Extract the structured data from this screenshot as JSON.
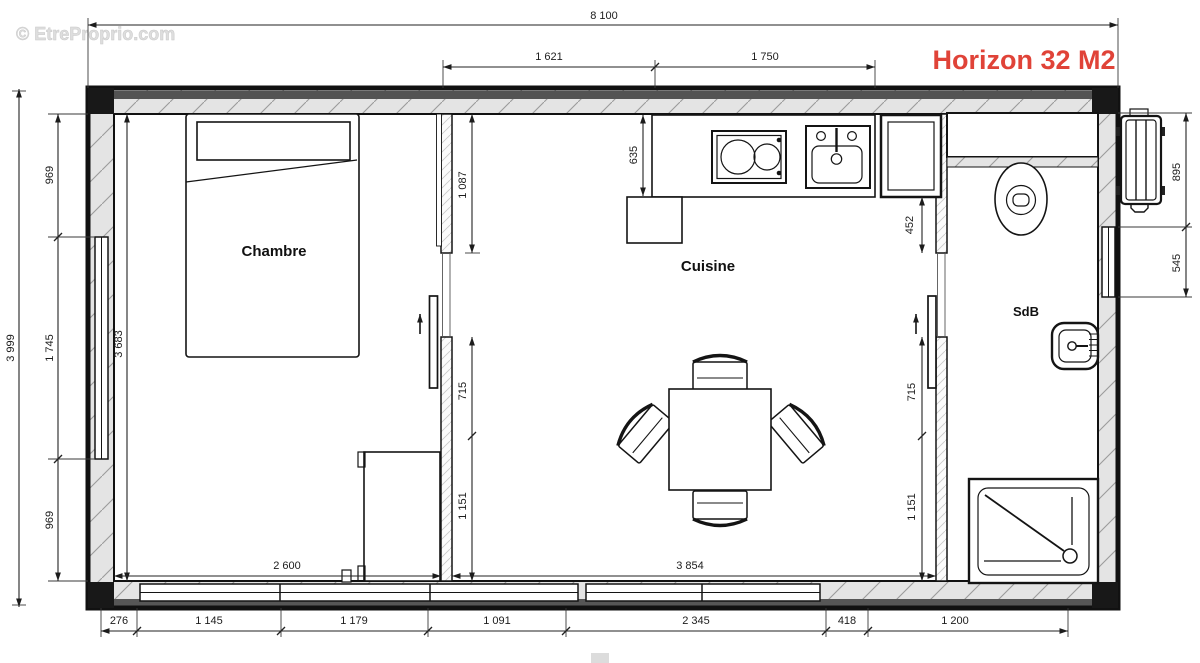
{
  "header": {
    "watermark": "© EtreProprio.com",
    "title": "Horizon 32 M2"
  },
  "rooms": {
    "bedroom": "Chambre",
    "kitchen": "Cuisine",
    "bathroom": "SdB"
  },
  "dims": {
    "overall_width": "8 100",
    "overall_height": "3 999",
    "top": [
      "1 621",
      "1 750"
    ],
    "left": [
      "969",
      "1 745",
      "969"
    ],
    "right": [
      "895",
      "545"
    ],
    "bottom": [
      "276",
      "1 145",
      "1 179",
      "1 091",
      "2 345",
      "418",
      "1 200"
    ],
    "bedroom_depth": "3 683",
    "bedroom_width": "2 600",
    "kitchen_width": "3 854",
    "counter_depth": "635",
    "partition_bedroom": [
      "1 087",
      "715",
      "1 151"
    ],
    "partition_bathroom": [
      "452",
      "715",
      "1 151"
    ]
  },
  "colors": {
    "accent": "#e04338",
    "watermark": "#dedede",
    "line": "#141414"
  }
}
